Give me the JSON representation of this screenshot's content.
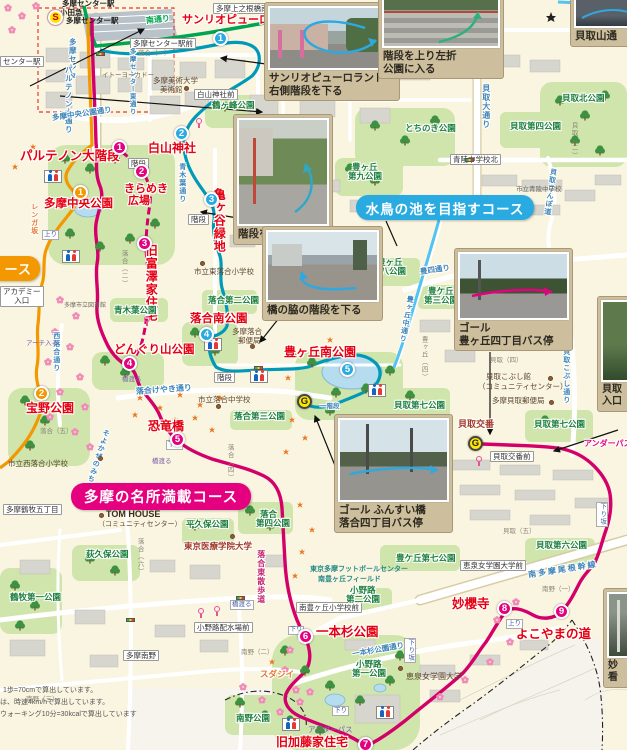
{
  "banners": {
    "pink": "多摩の名所満載コース",
    "blue": "水鳥の池を目指すコース",
    "orange_partial": "ース"
  },
  "markers": {
    "start": "S",
    "goal": "G",
    "pink": [
      "1",
      "2",
      "3",
      "4",
      "5",
      "6",
      "7",
      "8",
      "9"
    ],
    "blue": [
      "1",
      "2",
      "3",
      "4",
      "5"
    ],
    "orange": [
      "1",
      "2"
    ]
  },
  "captions": {
    "sanrio1": "サンリオピューロランド",
    "sanrio2": "右側階段を下る",
    "stairs_left1": "階段を上り左折",
    "stairs_left2": "公園に入る",
    "stairs_up": "階段を上がる",
    "bridge": "橋の脇の階段を下る",
    "goal_toyo1": "ゴール",
    "goal_toyo2": "豊ヶ丘四丁目バス停",
    "goal_funsui1": "ゴール ふんすい橋",
    "goal_funsui2": "落合四丁目バス停",
    "kaitori_in1": "貝取",
    "kaitori_in2": "入口",
    "kaitoriyama": "貝取山通",
    "myo1": "妙",
    "myo2": "看"
  },
  "poi": {
    "sanrio": "サンリオピューロランド",
    "parthenon": "パルテノン大階段",
    "hakusan": "白山神社",
    "kirameki_a": "きらめき",
    "kirameki_b": "広場",
    "chuo": "多摩中央公園",
    "kamegaya": "亀ヶ谷緑地",
    "tomizawa": "旧富澤家住宅",
    "ochiai_minami": "落合南公園",
    "donguri": "どんぐり山公園",
    "takarano": "宝野公園",
    "kyoryu": "恐竜橋",
    "toyo_minami": "豊ヶ丘南公園",
    "ipponsugi": "一本杉公園",
    "kato": "旧加藤家住宅",
    "myoo": "妙櫻寺",
    "yokoyama": "よこやまの道",
    "koban": "貝取交番"
  },
  "parks": {
    "tsurugamine": "鶴ヶ峰公園",
    "aokiba": "青木葉公園",
    "ochiai2": "落合第二公園",
    "ochiai3": "落合第三公園",
    "ochiai4_a": "落合",
    "ochiai4_b": "第四公園",
    "tochinoki": "とちのき公園",
    "toyo9a": "豊ヶ丘",
    "toyo9b": "第九公園",
    "toyo8a": "豊ヶ丘",
    "toyo8b": "第八公園",
    "toyo3a": "豊ケ丘",
    "toyo3b": "第三公園",
    "kaitori_kita": "貝取北公園",
    "kaitori4": "貝取第四公園",
    "kaitori_minami": "貝取南公園",
    "kaitori7": "貝取第七公園",
    "kaitori6": "貝取第六公園",
    "toyo7": "豊ケ丘第七公園",
    "hirakubo": "平久保公園",
    "ogikubo": "荻久保公園",
    "tsurumaki1": "鶴牧第一公園",
    "minamino": "南野公園",
    "onoji1a": "小野路",
    "onoji1b": "第一公園",
    "onoji2a": "小野路",
    "onoji2b": "第二公園"
  },
  "roads": {
    "minami": "南通り",
    "kaitori_odori": "貝取大通り",
    "sanpo": "貝取さんぽ道",
    "kobushi": "貝取こぶし通り",
    "toyo4": "豊四通り",
    "toyonaka": "豊ヶ丘中通り",
    "aokiba": "青木葉通り",
    "onekan": "南多摩尾根幹線",
    "keyaki": "落合けやき通り",
    "ipponsugi": "一本杉公園通り",
    "chuokoen": "多摩中央公園通り",
    "parthenon": "パルテノン大通り",
    "tc_higashi": "多摩センター東通り",
    "tc": "多摩センタ",
    "nishiochiai": "西落合通り",
    "soyokaze": "そよかぜのみち",
    "higashisanpo": "落合東散歩道",
    "renga": "レンガ坂"
  },
  "white_labels": {
    "uenone": "多摩上之根橋南",
    "ekimae": "多摩センター駅前",
    "hakusanmae": "白山神社前",
    "seiryokita": "青陵中学校北",
    "kobanmae": "貝取交番前",
    "keisenmae": "恵泉女学園大学前",
    "haisui": "小野路配水場前",
    "minamino": "多摩南野",
    "tsurumaki5": "多摩鶴牧五丁目",
    "minamitoyo": "南豊ヶ丘小学校前",
    "academy1": "アカデミー",
    "academy2": "入口",
    "kaidan": "階段",
    "center_eki": "センター駅"
  },
  "nav": {
    "hashiwataru": "橋渡る",
    "kudari": "下り",
    "nobori": "上り",
    "kudarizaka": "下り坂",
    "arch": "アーチ入る",
    "underpass": "アンダーパス",
    "ichikaidan": "一階段"
  },
  "inst": {
    "ito": "イトーヨーカドー",
    "bijutsu1": "多摩美術大学",
    "bijutsu2": "美術館",
    "library": "多摩市立図書館",
    "hochiai": "市立東落合小学校",
    "ochiaichu": "市立落合中学校",
    "nishiochiai": "市立西落合小学校",
    "seiryochu": "市立青陵中学校",
    "kaitorisho": "市立貝取小学校",
    "tom1": "TOM HOUSE",
    "tom2": "（コミュニティセンター）",
    "iryo": "東京医療学院大学",
    "keisen": "恵泉女学園大学",
    "fb1": "東京多摩フットボールセンター",
    "fb2": "南豊ヶ丘フィールド",
    "kobushikan1": "貝取こぶし館",
    "kobushikan2": "（コミュニティセンター）",
    "kyubin": "多摩貝取郵便局",
    "oyubin1": "多摩落合",
    "oyubin2": "郵便局",
    "sudajii": "スダジイ"
  },
  "districts": {
    "o1": "落合（一）",
    "o2": "落合（二）",
    "o4": "落合（四）",
    "o5": "落合（五）",
    "o6": "落合（六）",
    "m1": "南野（一）",
    "m2": "南野（二）",
    "m3": "南野（三）",
    "k2": "貝取（二）",
    "k4": "貝取（四）",
    "k5": "貝取（五）",
    "t4": "豊ヶ丘（四）"
  },
  "stations": {
    "eki1": "多摩センター駅",
    "odakyu": "小田急",
    "eki2": "多摩センター駅"
  },
  "notes": {
    "n1": "1歩=70cmで算出しています。",
    "n2": "は、時速4km/hで算出しています。",
    "n3": "ウォーキング10分=30kcalで算出しています"
  },
  "colors": {
    "course_pink": "#E4007F",
    "course_blue": "#29ABE2",
    "course_orange": "#F39800",
    "route_teal": "#0099B8",
    "goal_yellow": "#FFE600"
  }
}
